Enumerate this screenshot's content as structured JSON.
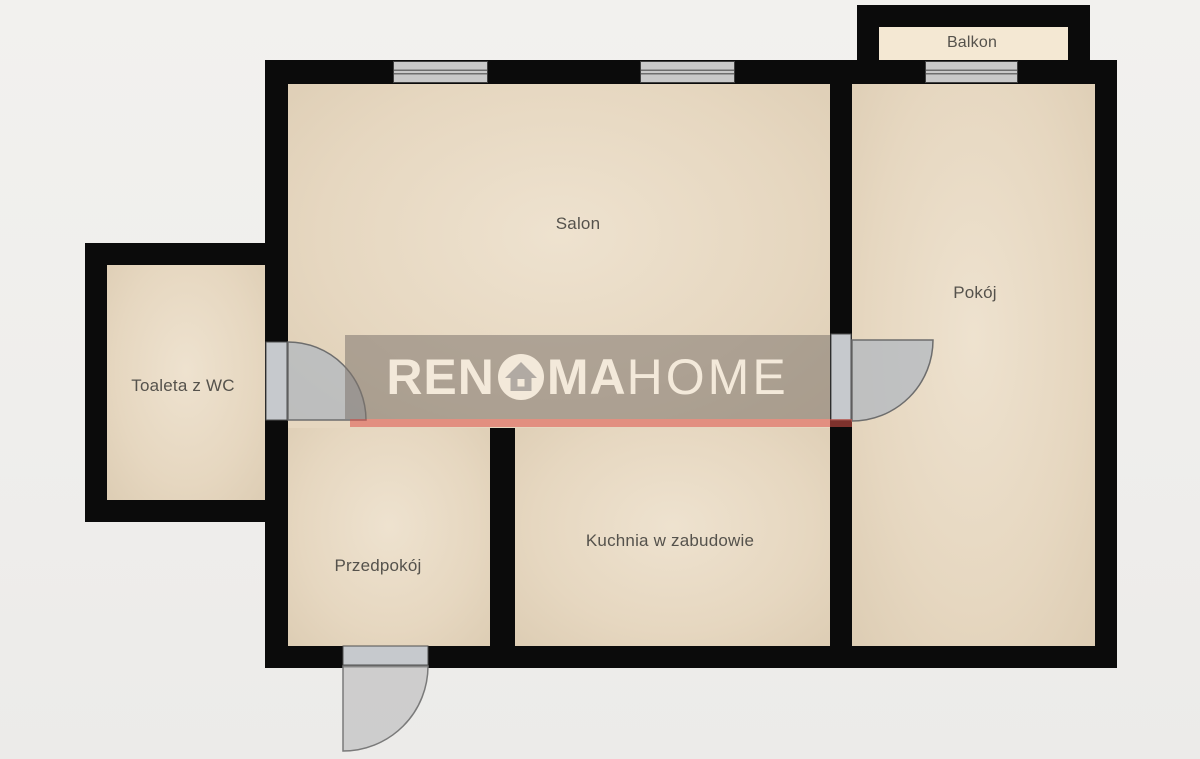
{
  "plan_title": "Apartment floor plan",
  "rooms": {
    "salon": {
      "label": "Salon"
    },
    "pokoj": {
      "label": "Pokój"
    },
    "toaleta": {
      "label": "Toaleta z WC"
    },
    "przedpokoj": {
      "label": "Przedpokój"
    },
    "kuchnia": {
      "label": "Kuchnia w zabudowie"
    },
    "balkon": {
      "label": "Balkon"
    }
  },
  "watermark": {
    "part1": "REN",
    "part2": "MA",
    "part3": "HOME"
  },
  "colors": {
    "background": "#f0efec",
    "wall": "#0b0b0b",
    "room_fill": "#e9dbc6",
    "balcony_fill": "#f4e8d3",
    "window_fill": "#c9c9c9",
    "door_fill": "#c6c9cd",
    "red_partition": "#de544a",
    "watermark_bg": "#b3aca5",
    "watermark_text": "#f3e9da",
    "label_text": "#55524c"
  }
}
